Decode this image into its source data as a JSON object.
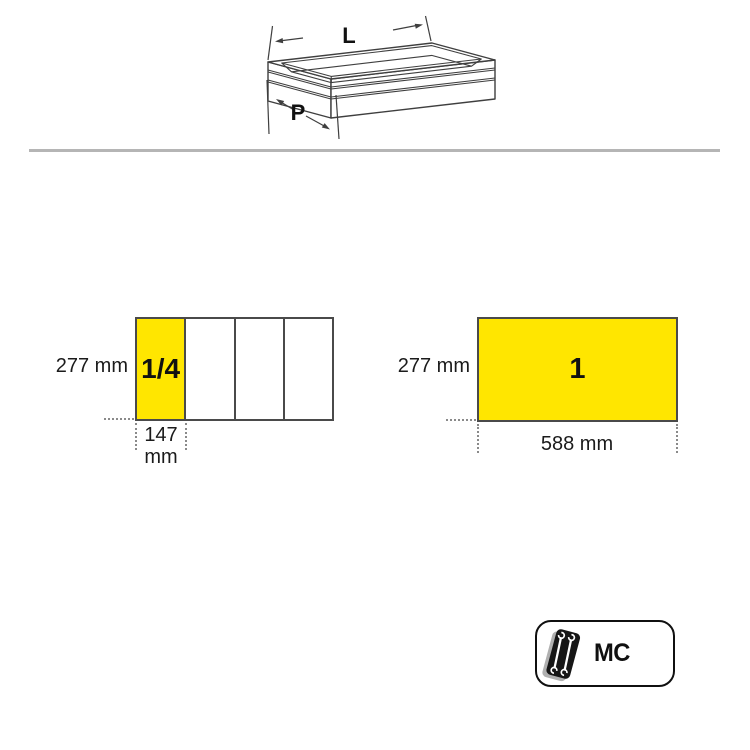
{
  "drawer_diagram": {
    "length_label": "L",
    "depth_label": "P",
    "icon": "drawer-isometric-icon"
  },
  "module_left": {
    "height_label": "277 mm",
    "width_value": "147",
    "width_unit": "mm",
    "fraction_label": "1/4",
    "sections": 4
  },
  "module_right": {
    "height_label": "277 mm",
    "width_label": "588 mm",
    "module_label": "1"
  },
  "badge": {
    "label": "MC",
    "icon": "wrench-tray-icon"
  },
  "colors": {
    "module_yellow": "#ffe600",
    "outline_gray": "#4a4a4a",
    "rule_gray": "#b5b5b5",
    "text_black": "#1b1b1b"
  }
}
